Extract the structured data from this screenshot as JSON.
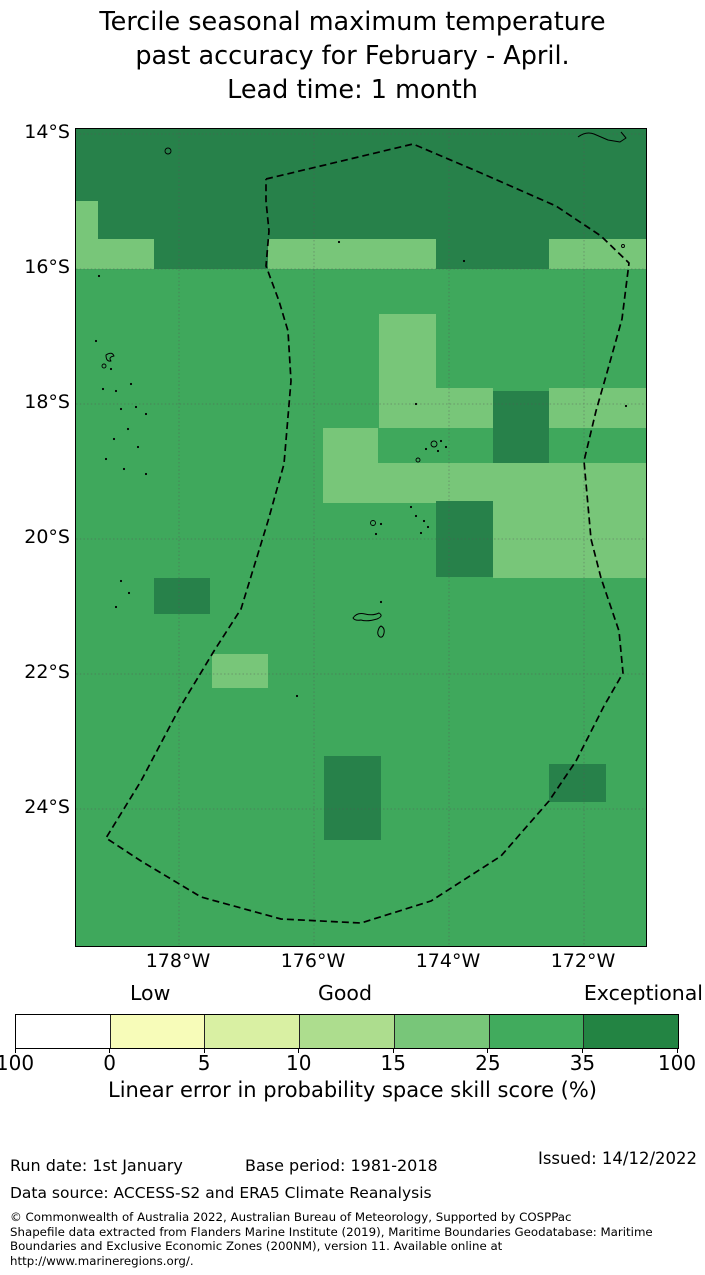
{
  "title": {
    "lines": [
      "Tercile seasonal maximum temperature",
      "past accuracy for February - April.",
      "Lead time: 1 month"
    ]
  },
  "map": {
    "y_axis_labels": [
      "14°S",
      "16°S",
      "18°S",
      "20°S",
      "22°S",
      "24°S"
    ],
    "x_axis_labels": [
      "178°W",
      "176°W",
      "174°W",
      "172°W"
    ]
  },
  "colorbar": {
    "categories": [
      "Low",
      "Good",
      "Exceptional"
    ],
    "tick_labels": [
      "100",
      "0",
      "5",
      "10",
      "15",
      "25",
      "35",
      "100"
    ],
    "segment_colors": [
      "#ffffff",
      "#f7fcb9",
      "#d9f0a3",
      "#addd8e",
      "#78c679",
      "#41ab5d",
      "#238443"
    ],
    "axis_label": "Linear error in probability space skill score (%)"
  },
  "footer": {
    "run_date": "Run date: 1st January",
    "base_period": "Base period: 1981-2018",
    "issued": "Issued: 14/12/2022",
    "data_source": "Data source: ACCESS-S2 and ERA5 Climate Reanalysis",
    "copyright_lines": [
      "© Commonwealth of Australia 2022, Australian Bureau of Meteorology, Supported by COSPPac",
      "Shapefile data extracted from Flanders Marine Institute (2019), Maritime Boundaries Geodatabase: Maritime",
      "Boundaries and Exclusive Economic Zones (200NM), version 11. Available online at",
      "http://www.marineregions.org/."
    ]
  },
  "chart_data": {
    "type": "heatmap",
    "subtype": "geographic skill map over Tonga region EEZ",
    "title": "Tercile seasonal maximum temperature past accuracy for February - April. Lead time: 1 month",
    "lat_gridlines": [
      "14°S",
      "16°S",
      "18°S",
      "20°S",
      "22°S",
      "24°S"
    ],
    "lon_gridlines": [
      "178°W",
      "176°W",
      "174°W",
      "172°W"
    ],
    "scale": {
      "label": "Linear error in probability space skill score (%)",
      "tick_labels_displayed": [
        "100",
        "0",
        "5",
        "10",
        "15",
        "25",
        "35",
        "100"
      ],
      "category_labels": [
        "Low",
        "Good",
        "Exceptional"
      ],
      "colors": [
        "#ffffff",
        "#f7fcb9",
        "#d9f0a3",
        "#addd8e",
        "#78c679",
        "#41ab5d",
        "#238443"
      ]
    },
    "skill_levels": {
      "base": {
        "approx_range_pct": "25-35",
        "color": "#3fa85c"
      },
      "light": {
        "approx_range_pct": "15-25",
        "color": "#78c679"
      },
      "dark": {
        "approx_range_pct": "35-100",
        "color": "#27814a"
      }
    },
    "map_px": {
      "width": 570,
      "height": 817
    },
    "cells": [
      {
        "x": 0,
        "y": 0,
        "w": 570,
        "h": 72,
        "l": "dark"
      },
      {
        "x": 22,
        "y": 72,
        "w": 548,
        "h": 38,
        "l": "dark"
      },
      {
        "x": 0,
        "y": 72,
        "w": 22,
        "h": 68,
        "l": "light"
      },
      {
        "x": 22,
        "y": 110,
        "w": 56,
        "h": 30,
        "l": "light"
      },
      {
        "x": 78,
        "y": 110,
        "w": 114,
        "h": 30,
        "l": "dark"
      },
      {
        "x": 192,
        "y": 110,
        "w": 168,
        "h": 30,
        "l": "light"
      },
      {
        "x": 360,
        "y": 110,
        "w": 113,
        "h": 30,
        "l": "dark"
      },
      {
        "x": 473,
        "y": 110,
        "w": 97,
        "h": 30,
        "l": "light"
      },
      {
        "x": 303,
        "y": 185,
        "w": 57,
        "h": 74,
        "l": "light"
      },
      {
        "x": 303,
        "y": 259,
        "w": 114,
        "h": 40,
        "l": "light"
      },
      {
        "x": 473,
        "y": 259,
        "w": 97,
        "h": 40,
        "l": "light"
      },
      {
        "x": 417,
        "y": 262,
        "w": 56,
        "h": 72,
        "l": "dark"
      },
      {
        "x": 247,
        "y": 299,
        "w": 55,
        "h": 75,
        "l": "light"
      },
      {
        "x": 302,
        "y": 334,
        "w": 115,
        "h": 40,
        "l": "light"
      },
      {
        "x": 417,
        "y": 334,
        "w": 153,
        "h": 115,
        "l": "light"
      },
      {
        "x": 360,
        "y": 372,
        "w": 57,
        "h": 76,
        "l": "dark"
      },
      {
        "x": 78,
        "y": 449,
        "w": 56,
        "h": 36,
        "l": "dark"
      },
      {
        "x": 136,
        "y": 525,
        "w": 56,
        "h": 34,
        "l": "light"
      },
      {
        "x": 248,
        "y": 627,
        "w": 57,
        "h": 84,
        "l": "dark"
      },
      {
        "x": 473,
        "y": 635,
        "w": 57,
        "h": 38,
        "l": "dark"
      }
    ],
    "gridlines_px": {
      "h": [
        5,
        140,
        275,
        410,
        545,
        680
      ],
      "v": [
        103,
        238,
        373,
        508
      ]
    },
    "eez_boundary_px": [
      [
        190,
        50
      ],
      [
        337,
        15
      ],
      [
        405,
        44
      ],
      [
        480,
        77
      ],
      [
        525,
        107
      ],
      [
        553,
        134
      ],
      [
        546,
        190
      ],
      [
        532,
        240
      ],
      [
        520,
        282
      ],
      [
        508,
        332
      ],
      [
        515,
        410
      ],
      [
        525,
        449
      ],
      [
        543,
        502
      ],
      [
        547,
        544
      ],
      [
        528,
        577
      ],
      [
        500,
        632
      ],
      [
        473,
        672
      ],
      [
        425,
        727
      ],
      [
        355,
        772
      ],
      [
        285,
        794
      ],
      [
        205,
        790
      ],
      [
        125,
        768
      ],
      [
        65,
        732
      ],
      [
        30,
        709
      ],
      [
        65,
        652
      ],
      [
        103,
        580
      ],
      [
        138,
        522
      ],
      [
        165,
        480
      ],
      [
        192,
        392
      ],
      [
        208,
        335
      ],
      [
        215,
        252
      ],
      [
        212,
        202
      ],
      [
        203,
        172
      ],
      [
        190,
        137
      ],
      [
        193,
        102
      ],
      [
        190,
        72
      ],
      [
        190,
        50
      ]
    ],
    "islands": {
      "dots": [
        [
          23,
          147
        ],
        [
          20,
          212
        ],
        [
          35,
          240
        ],
        [
          27,
          260
        ],
        [
          40,
          262
        ],
        [
          55,
          255
        ],
        [
          45,
          280
        ],
        [
          60,
          278
        ],
        [
          70,
          285
        ],
        [
          52,
          300
        ],
        [
          38,
          310
        ],
        [
          62,
          318
        ],
        [
          30,
          330
        ],
        [
          48,
          340
        ],
        [
          70,
          345
        ],
        [
          45,
          452
        ],
        [
          53,
          464
        ],
        [
          40,
          478
        ],
        [
          263,
          113
        ],
        [
          388,
          132
        ],
        [
          340,
          275
        ],
        [
          350,
          320
        ],
        [
          365,
          312
        ],
        [
          370,
          318
        ],
        [
          362,
          322
        ],
        [
          335,
          378
        ],
        [
          340,
          387
        ],
        [
          348,
          392
        ],
        [
          352,
          398
        ],
        [
          345,
          404
        ],
        [
          305,
          395
        ],
        [
          300,
          405
        ],
        [
          221,
          567
        ],
        [
          305,
          473
        ],
        [
          550,
          277
        ]
      ],
      "rings": [
        [
          92,
          22,
          3
        ],
        [
          547,
          117,
          1.5
        ],
        [
          358,
          315,
          3
        ],
        [
          342,
          331,
          2
        ],
        [
          297,
          394,
          2.5
        ],
        [
          28,
          237,
          2
        ]
      ],
      "paths": [
        "M502,8 q8,-6 16,-3 l14,6 12,2 6,-4 -5,-6",
        "M277,489 q4,-6 12,-4 q8,2 14,-1 q5,3 -2,6 q-10,3 -16,1 q-6,1 -8,-2 z",
        "M305,497 q4,2 3,7 q-1,5 -4,4 q-3,-2 -2,-6 q1,-4 3,-5 z",
        "M30,226 q6,-4 8,1 q-6,1 -3,5 q-5,1 -5,-6 z"
      ]
    }
  }
}
